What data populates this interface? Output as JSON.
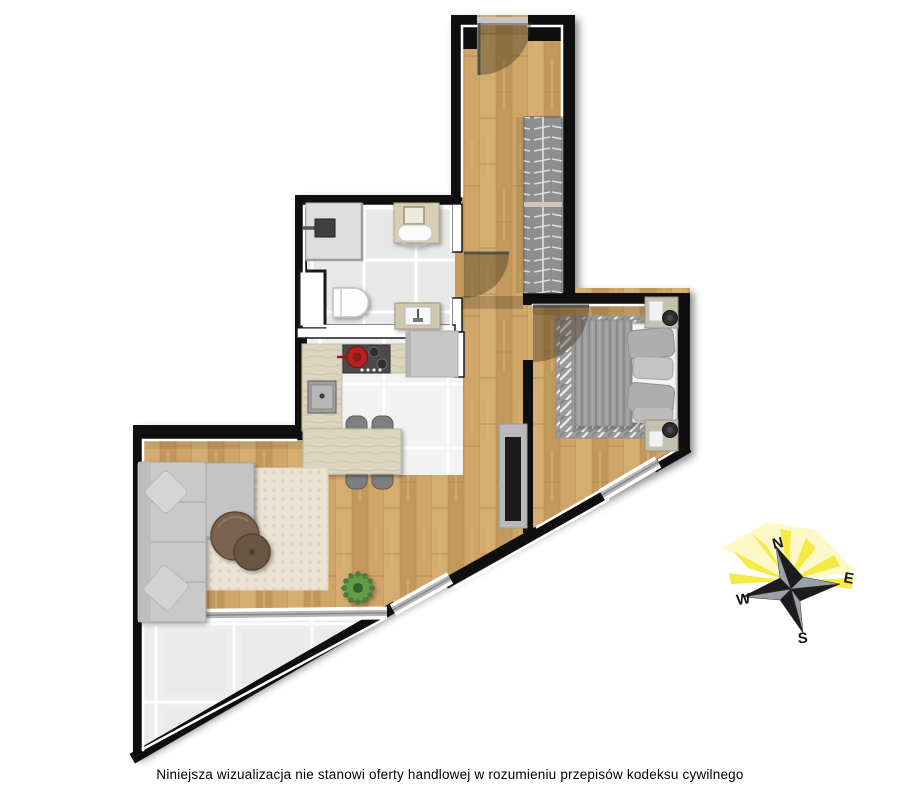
{
  "disclaimer": "Niniejsza wizualizacja nie stanowi oferty handlowej w rozumieniu przepisów kodeksu cywilnego",
  "compass": {
    "north": "N",
    "east": "E",
    "south": "S",
    "west": "W"
  },
  "colors": {
    "background": "#ffffff",
    "wall": "#0f0f0f",
    "wall_partition": "#ffffff",
    "wood_floor": "#cda367",
    "bathroom_tile": "#e9e9e9",
    "kitchen_tile": "#f2f2f2",
    "terrace_tile": "#ededed",
    "grout": "#ffffff",
    "window_glass": "#b4b4b4",
    "door_shadow": "rgba(62,50,28,0.40)",
    "wardrobe_grey": "#8e8e8e",
    "sofa_grey": "#c9c9c9",
    "rug_living": "#eae3d1",
    "rug_bedroom": "#9b9b9b",
    "duvet_grey": "#9d9d9d",
    "counter_stone": "#dbd4bf",
    "counter_grey": "#c7c7c7",
    "stool_grey": "#7f7f7f",
    "coffee_table_wood": "#7a6250",
    "pot_red": "#b22222",
    "plant_green": "#4e7d3a",
    "compass_rays": "#f6e93d",
    "compass_star_dark": "#1c1c1c",
    "compass_star_light": "#9aa0a6"
  },
  "rooms": [
    "entrance-hall",
    "bathroom",
    "kitchen",
    "living-room",
    "bedroom",
    "terrace"
  ],
  "furniture": [
    "entrance-door",
    "wardrobe",
    "shower",
    "vanity-sink",
    "toilet",
    "washing-machine",
    "kitchen-counter",
    "stove-with-pot",
    "kitchen-sink",
    "dining-table",
    "stools",
    "corner-sofa",
    "pillows",
    "coffee-tables",
    "living-rug",
    "plant",
    "tv-panel",
    "bed",
    "bedroom-rug",
    "nightstands",
    "lamps"
  ]
}
